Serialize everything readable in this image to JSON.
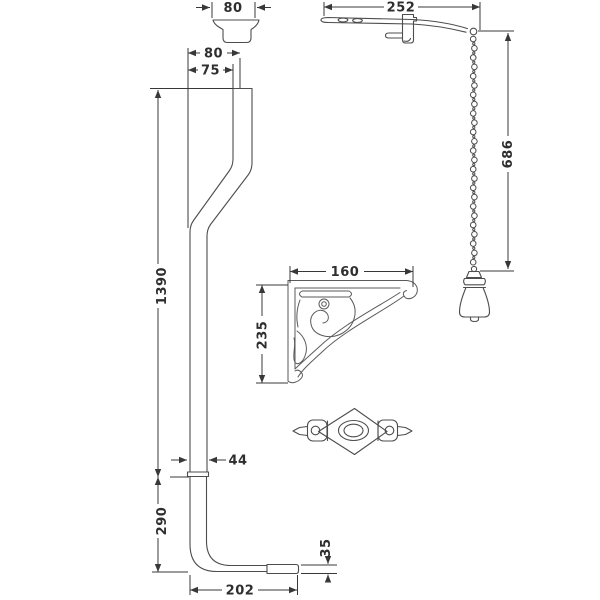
{
  "drawing": {
    "background_color": "#ffffff",
    "dimension_line_color": "#383838",
    "part_line_color": "#4d4d4d",
    "parts": [
      "cistern-cone-connector",
      "flush-lever-arm",
      "pull-chain",
      "ceramic-pull-handle",
      "flush-pipe",
      "ornate-wall-bracket",
      "diamond-escutcheon-plate"
    ],
    "dims": {
      "connector_width": "80",
      "lever_length": "252",
      "chain_length": "686",
      "pipe_offset_outer": "80",
      "pipe_offset_inner": "75",
      "pipe_upper_length": "1390",
      "pipe_lower_length": "290",
      "pipe_diameter": "44",
      "bottom_run": "202",
      "outlet_height": "35",
      "bracket_width": "160",
      "bracket_height": "235"
    }
  }
}
